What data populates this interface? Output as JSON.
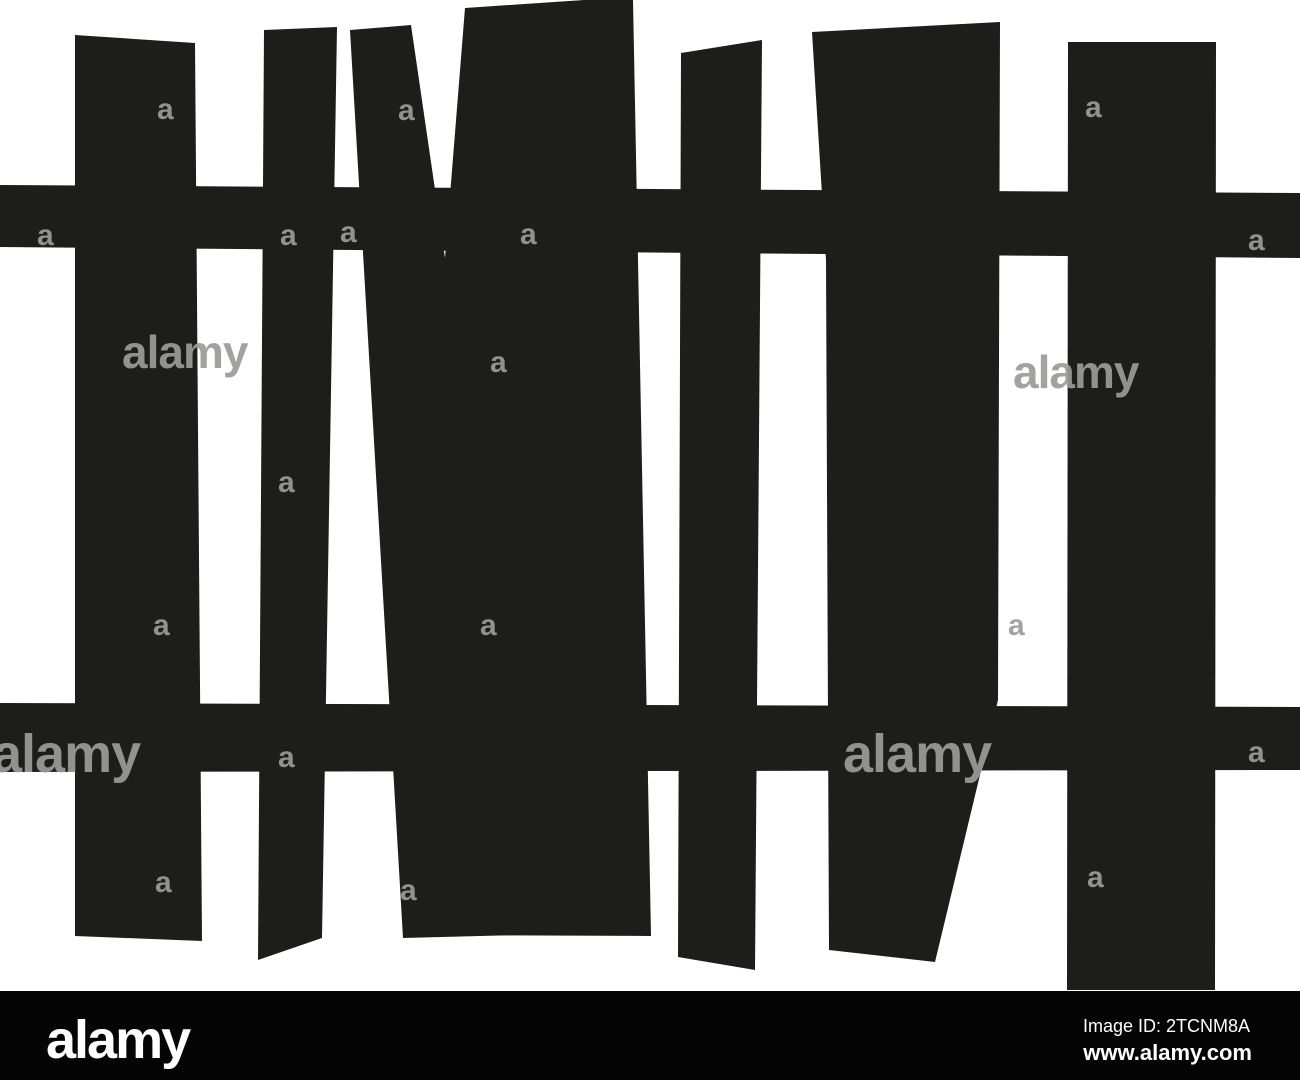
{
  "image": {
    "width": 1300,
    "height": 1080,
    "background": "#ffffff"
  },
  "fence": {
    "color": "#1d1d1b",
    "pickets": [
      {
        "name": "picket-1",
        "points": "75,35 195,43 202,941 75,936"
      },
      {
        "name": "picket-2",
        "points": "264,30 337,27 322,938 258,960"
      },
      {
        "name": "picket-3-narrow",
        "points": "350,30 411,25 445,258 520,935 403,938"
      },
      {
        "name": "picket-4-wide",
        "points": "465,8 584,0 633,0 651,936 420,935 445,258"
      },
      {
        "name": "picket-5",
        "points": "681,53 762,40 755,970 678,957"
      },
      {
        "name": "picket-6",
        "points": "812,32 1000,22 998,700 935,962 829,950 826,260"
      },
      {
        "name": "picket-7",
        "points": "1068,42 1216,42 1215,990 1067,990"
      }
    ],
    "rails": [
      {
        "name": "upper-rail",
        "points": "0,185 1300,193 1300,258 0,247"
      },
      {
        "name": "lower-rail",
        "points": "0,703 1300,707 1300,770 0,772"
      }
    ]
  },
  "watermark": {
    "color": "#9b9b9a",
    "opacity": 0.92,
    "marks": [
      {
        "text": "a",
        "x": 157,
        "y": 119,
        "size": 30
      },
      {
        "text": "a",
        "x": 398,
        "y": 120,
        "size": 30
      },
      {
        "text": "a",
        "x": 1085,
        "y": 117,
        "size": 30
      },
      {
        "text": "a",
        "x": 37,
        "y": 245,
        "size": 30
      },
      {
        "text": "a",
        "x": 280,
        "y": 245,
        "size": 30
      },
      {
        "text": "a",
        "x": 340,
        "y": 242,
        "size": 30
      },
      {
        "text": "a",
        "x": 520,
        "y": 244,
        "size": 30
      },
      {
        "text": "a",
        "x": 1248,
        "y": 250,
        "size": 30
      },
      {
        "text": "a",
        "x": 490,
        "y": 372,
        "size": 30
      },
      {
        "text": "a",
        "x": 278,
        "y": 492,
        "size": 30
      },
      {
        "text": "a",
        "x": 153,
        "y": 635,
        "size": 30
      },
      {
        "text": "a",
        "x": 480,
        "y": 635,
        "size": 30
      },
      {
        "text": "a",
        "x": 1008,
        "y": 635,
        "size": 30
      },
      {
        "text": "a",
        "x": 278,
        "y": 767,
        "size": 30
      },
      {
        "text": "a",
        "x": 1248,
        "y": 762,
        "size": 30
      },
      {
        "text": "a",
        "x": 155,
        "y": 892,
        "size": 30
      },
      {
        "text": "a",
        "x": 400,
        "y": 900,
        "size": 30
      },
      {
        "text": "a",
        "x": 1087,
        "y": 887,
        "size": 30
      }
    ],
    "words": [
      {
        "text": "alamy",
        "x": -8,
        "y": 772,
        "size": 54
      },
      {
        "text": "alamy",
        "x": 843,
        "y": 772,
        "size": 54
      },
      {
        "text": "alamy",
        "x": 122,
        "y": 368,
        "size": 46
      },
      {
        "text": "alamy",
        "x": 1013,
        "y": 388,
        "size": 46
      }
    ]
  },
  "footer_bar": {
    "background": "#050505",
    "text_color": "#ffffff",
    "logo": "alamy",
    "image_id_label": "Image ID: 2TCNM8A",
    "url": "www.alamy.com"
  }
}
